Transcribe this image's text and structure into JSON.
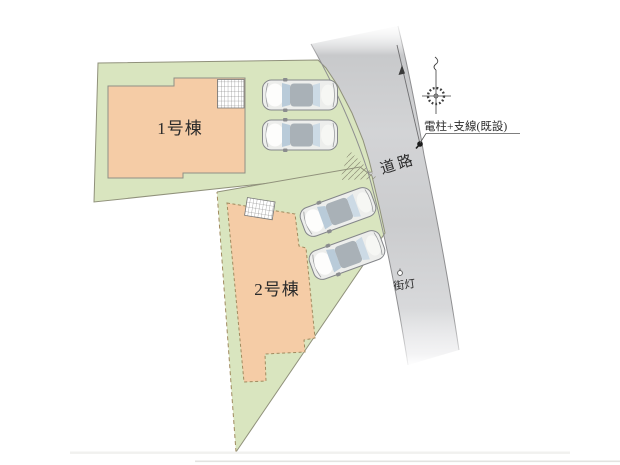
{
  "plan": {
    "type": "residential-site-plan",
    "labels": {
      "building1": "1号棟",
      "building2": "2号棟",
      "road": "道路",
      "utility_pole": "電柱+支線(既設)",
      "street_light": "街灯"
    },
    "colors": {
      "lot_green": "#d9e5bf",
      "building_fill": "#f5cca6",
      "road_gray": "#cdced0",
      "outline_gray": "#90917b"
    }
  },
  "cars": [
    {
      "cx": 300,
      "cy": 95,
      "rotation": 0
    },
    {
      "cx": 300,
      "cy": 135,
      "rotation": 0
    },
    {
      "cx": 338,
      "cy": 212,
      "rotation": -20
    },
    {
      "cx": 347,
      "cy": 255,
      "rotation": -20
    }
  ]
}
